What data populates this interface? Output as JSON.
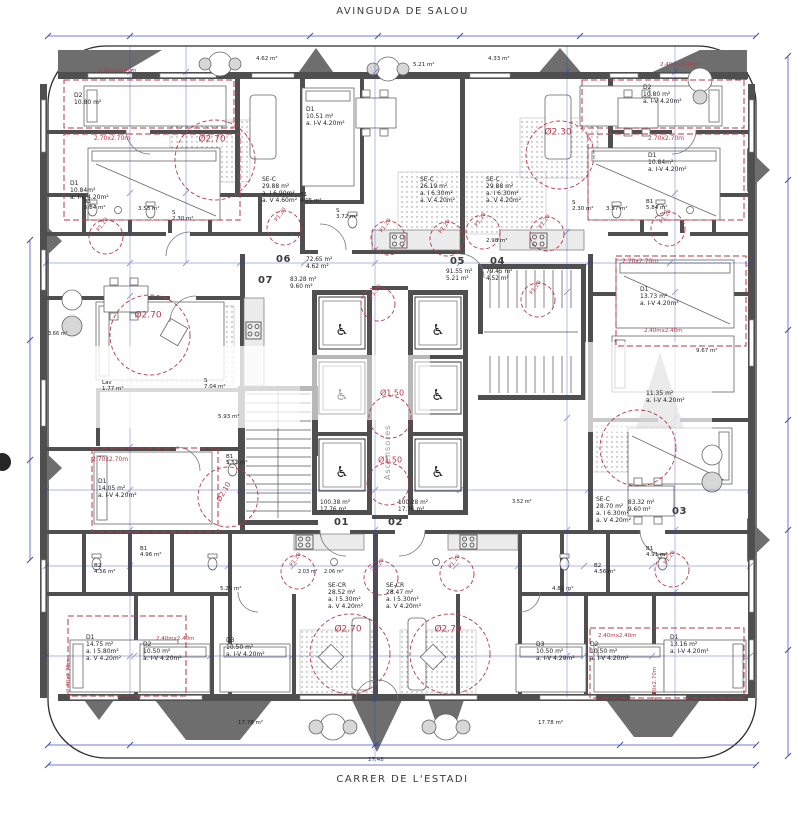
{
  "drawing": {
    "street_top": "AVINGUDA DE SALOU",
    "street_bottom": "CARRER DE L'ESTADI",
    "overall_dim": "27.48",
    "core": {
      "elevator_text": "Ascensores",
      "wheelchair_glyph": "♿",
      "cabins": 6
    },
    "colors": {
      "wall": "#4f4f4f",
      "red": "#b5394a",
      "blue": "#2e41b0",
      "divider": "#6e6e6e"
    },
    "units": [
      {
        "number": "07",
        "areas": [
          "83.28 m²",
          "9.60 m²"
        ],
        "nx": 258,
        "ny": 275,
        "ax": 290,
        "ay": 277
      },
      {
        "number": "06",
        "areas": [
          "72.65 m²",
          "4.62 m²"
        ],
        "nx": 276,
        "ny": 254,
        "ax": 306,
        "ay": 257
      },
      {
        "number": "05",
        "areas": [
          "91.55 m²",
          "5.21 m²"
        ],
        "nx": 450,
        "ny": 256,
        "ax": 446,
        "ay": 269
      },
      {
        "number": "04",
        "areas": [
          "79.45 m²",
          "4.52 m²"
        ],
        "nx": 490,
        "ny": 256,
        "ax": 486,
        "ay": 269
      },
      {
        "number": "01",
        "areas": [
          "100.38 m²",
          "17.76 m²"
        ],
        "nx": 334,
        "ny": 517,
        "ax": 320,
        "ay": 500
      },
      {
        "number": "02",
        "areas": [
          "100.28 m²",
          "17.76 m²"
        ],
        "nx": 388,
        "ny": 517,
        "ax": 398,
        "ay": 500
      },
      {
        "number": "03",
        "areas": [
          "83.32 m²",
          "9.60 m²"
        ],
        "nx": 672,
        "ny": 506,
        "ax": 628,
        "ay": 500
      }
    ],
    "room_labels": [
      {
        "name": "bedroom-d2-tl",
        "lines": [
          "D2",
          "10.80 m²"
        ],
        "x": 74,
        "y": 92
      },
      {
        "name": "bedroom-d1-tl",
        "lines": [
          "D1",
          "10.84m²",
          "a. I-V 4.20m²"
        ],
        "x": 70,
        "y": 180
      },
      {
        "name": "bath-b1-tl",
        "lines": [
          "B1",
          "5.84 m²"
        ],
        "x": 84,
        "y": 199,
        "size": 5.5
      },
      {
        "name": "bath-tl",
        "lines": [
          "3.53 m²"
        ],
        "x": 138,
        "y": 206,
        "size": 5.5
      },
      {
        "name": "storage-tl",
        "lines": [
          "S",
          "2.30 m²"
        ],
        "x": 172,
        "y": 210,
        "size": 5.5
      },
      {
        "name": "bedroom-d2-tr",
        "lines": [
          "D2",
          "10.80 m²",
          "a. I-V 4.20m²"
        ],
        "x": 643,
        "y": 84
      },
      {
        "name": "bedroom-d1-tr",
        "lines": [
          "D1",
          "10.84m²",
          "a. I-V 4.20m²"
        ],
        "x": 648,
        "y": 152
      },
      {
        "name": "bath-tr",
        "lines": [
          "3.57 m²"
        ],
        "x": 606,
        "y": 206,
        "size": 5.5
      },
      {
        "name": "bath-b1-tr",
        "lines": [
          "B1",
          "5.84 m²"
        ],
        "x": 646,
        "y": 199,
        "size": 5.5
      },
      {
        "name": "bedroom-d1-tc",
        "lines": [
          "D1",
          "10.51 m²",
          "a. I-V 4.20m²"
        ],
        "x": 306,
        "y": 106
      },
      {
        "name": "living-sec-06",
        "lines": [
          "SE-C",
          "29.88 m²",
          "a. I 6.90m²",
          "a. V 4.60m²"
        ],
        "x": 262,
        "y": 176
      },
      {
        "name": "living-sec-05",
        "lines": [
          "SE-C",
          "26.19 m²",
          "a. I 6.30m²",
          "a. V 4.20m²"
        ],
        "x": 420,
        "y": 176
      },
      {
        "name": "living-sec-04",
        "lines": [
          "SE-C",
          "29.88 m²",
          "a. I 6.30m²",
          "a. V 4.20m²"
        ],
        "x": 486,
        "y": 176
      },
      {
        "name": "bath-b1-06",
        "lines": [
          "B1",
          "4.05 m²"
        ],
        "x": 300,
        "y": 192,
        "size": 5.5
      },
      {
        "name": "storage-06",
        "lines": [
          "S",
          "3.72 m²"
        ],
        "x": 336,
        "y": 208,
        "size": 5.5
      },
      {
        "name": "hall-04",
        "lines": [
          "2.98 m²"
        ],
        "x": 486,
        "y": 238,
        "size": 5.5
      },
      {
        "name": "storage-04",
        "lines": [
          "S",
          "2.30 m²"
        ],
        "x": 572,
        "y": 200,
        "size": 5.5
      },
      {
        "name": "laundry-07",
        "lines": [
          "Lav",
          "1.77 m²"
        ],
        "x": 102,
        "y": 380,
        "size": 5.5
      },
      {
        "name": "storage-07",
        "lines": [
          "S",
          "7.04 m²"
        ],
        "x": 204,
        "y": 378,
        "size": 5.5
      },
      {
        "name": "hall-07",
        "lines": [
          "5.93 m²"
        ],
        "x": 218,
        "y": 414,
        "size": 5.5
      },
      {
        "name": "bath-b1-07",
        "lines": [
          "B1",
          "5.52 m²"
        ],
        "x": 226,
        "y": 454,
        "size": 5.5
      },
      {
        "name": "bedroom-d1-07",
        "lines": [
          "D1",
          "14.05 m²",
          "a. I-V 4.20m²"
        ],
        "x": 98,
        "y": 478
      },
      {
        "name": "balcony-left",
        "lines": [
          "3.66 m²"
        ],
        "x": 48,
        "y": 332,
        "size": 5
      },
      {
        "name": "bedroom-d1-03",
        "lines": [
          "D1",
          "13.73 m²",
          "a. I-V 4.20m²"
        ],
        "x": 640,
        "y": 286
      },
      {
        "name": "balcony-right",
        "lines": [
          "9.67 m²"
        ],
        "x": 696,
        "y": 348,
        "size": 5.5
      },
      {
        "name": "bedroom-d2-03",
        "lines": [
          "11.35 m²",
          "a. I-V 4.20m²"
        ],
        "x": 646,
        "y": 390
      },
      {
        "name": "living-sec-03",
        "lines": [
          "SE-C",
          "28.70 m²",
          "a. I 6.30m²",
          "a. V 4.20m²"
        ],
        "x": 596,
        "y": 496
      },
      {
        "name": "bath-b1-03",
        "lines": [
          "B1",
          "4.91 m²"
        ],
        "x": 646,
        "y": 546,
        "size": 5.5
      },
      {
        "name": "bath-b2-03",
        "lines": [
          "B2",
          "4.56 m²"
        ],
        "x": 594,
        "y": 563,
        "size": 5.5
      },
      {
        "name": "bath-b1-left",
        "lines": [
          "B1",
          "4.96 m²"
        ],
        "x": 140,
        "y": 546,
        "size": 5.5
      },
      {
        "name": "bath-b2-left",
        "lines": [
          "B2",
          "4.56 m²"
        ],
        "x": 94,
        "y": 563,
        "size": 5.5
      },
      {
        "name": "storage-01",
        "lines": [
          "2.03 m²"
        ],
        "x": 298,
        "y": 570,
        "size": 5
      },
      {
        "name": "storage-02",
        "lines": [
          "2.06 m²"
        ],
        "x": 324,
        "y": 570,
        "size": 5
      },
      {
        "name": "hall-left",
        "lines": [
          "5.25 m²"
        ],
        "x": 220,
        "y": 586,
        "size": 5.5
      },
      {
        "name": "hall-right",
        "lines": [
          "4.81 m²"
        ],
        "x": 552,
        "y": 586,
        "size": 5.5
      },
      {
        "name": "living-secr-01",
        "lines": [
          "SE-CR",
          "28.52 m²",
          "a. I 5.30m²",
          "a. V 4.20m²"
        ],
        "x": 328,
        "y": 582
      },
      {
        "name": "living-secr-02",
        "lines": [
          "SE-CR",
          "28.47 m²",
          "a. I 5.30m²",
          "a. V 4.20m²"
        ],
        "x": 386,
        "y": 582
      },
      {
        "name": "bedroom-d1-bl",
        "lines": [
          "D1",
          "14.75 m²",
          "a. I 5.80m²",
          "a. V 4.20m²"
        ],
        "x": 86,
        "y": 634
      },
      {
        "name": "bedroom-d2-bl",
        "lines": [
          "D2",
          "10.50 m²",
          "a. I-V 4.20m²"
        ],
        "x": 143,
        "y": 641
      },
      {
        "name": "bedroom-d3-bl",
        "lines": [
          "D3",
          "10.50 m²",
          "a. I-V 4.20m²"
        ],
        "x": 226,
        "y": 637
      },
      {
        "name": "bedroom-d3-br",
        "lines": [
          "D3",
          "10.50 m²",
          "a. I-V 4.20m²"
        ],
        "x": 536,
        "y": 641
      },
      {
        "name": "bedroom-d2-br",
        "lines": [
          "D2",
          "10.50 m²",
          "a. I-V 4.20m²"
        ],
        "x": 590,
        "y": 641
      },
      {
        "name": "bedroom-d1-br",
        "lines": [
          "D1",
          "13.16 m²",
          "a. I-V 4.20m²"
        ],
        "x": 670,
        "y": 634
      },
      {
        "name": "balcony-bl",
        "lines": [
          "17.78 m²"
        ],
        "x": 238,
        "y": 720,
        "size": 5.5
      },
      {
        "name": "balcony-br",
        "lines": [
          "17.78 m²"
        ],
        "x": 538,
        "y": 720,
        "size": 5.5
      },
      {
        "name": "balcony-t1",
        "lines": [
          "4.62 m²"
        ],
        "x": 256,
        "y": 56,
        "size": 5.5
      },
      {
        "name": "balcony-t2",
        "lines": [
          "5.21 m²"
        ],
        "x": 413,
        "y": 62,
        "size": 5.5
      },
      {
        "name": "balcony-t3",
        "lines": [
          "4.33 m²"
        ],
        "x": 488,
        "y": 56,
        "size": 5.5
      },
      {
        "name": "hall-03",
        "lines": [
          "3.52 m²"
        ],
        "x": 512,
        "y": 500,
        "size": 5
      }
    ],
    "red_labels": [
      {
        "name": "bed-clearance",
        "text": "2.40mx2.40m",
        "x": 98,
        "y": 68,
        "size": 5.5
      },
      {
        "name": "bed-clearance",
        "text": "2.70x2.70m",
        "x": 94,
        "y": 135,
        "size": 6
      },
      {
        "name": "bed-clearance",
        "text": "2.40mx2.40m",
        "x": 660,
        "y": 62,
        "size": 5.5
      },
      {
        "name": "bed-clearance",
        "text": "2.70x2.70m",
        "x": 648,
        "y": 135,
        "size": 6
      },
      {
        "name": "turning-diameter",
        "text": "Ø2.70",
        "x": 212,
        "y": 140,
        "size": 9,
        "anchor": "c"
      },
      {
        "name": "turning-diameter",
        "text": "Ø2.30",
        "x": 558,
        "y": 133,
        "size": 9,
        "anchor": "c"
      },
      {
        "name": "turning-diameter",
        "text": "Ø2.70",
        "x": 148,
        "y": 316,
        "size": 9,
        "anchor": "c"
      },
      {
        "name": "turning-diameter",
        "text": "Ø1.50",
        "x": 392,
        "y": 393,
        "size": 8,
        "anchor": "c"
      },
      {
        "name": "turning-diameter",
        "text": "Ø1.50",
        "x": 390,
        "y": 460,
        "size": 8,
        "anchor": "c"
      },
      {
        "name": "turning-diameter",
        "text": "Ø2.70",
        "x": 348,
        "y": 630,
        "size": 9,
        "anchor": "c"
      },
      {
        "name": "turning-diameter",
        "text": "Ø2.70",
        "x": 448,
        "y": 630,
        "size": 9,
        "anchor": "c"
      },
      {
        "name": "bed-clearance",
        "text": "2.70x2.70m",
        "x": 622,
        "y": 258,
        "size": 6
      },
      {
        "name": "bed-clearance",
        "text": "2.40mx2.40m",
        "x": 644,
        "y": 328,
        "size": 5.5
      },
      {
        "name": "bed-clearance",
        "text": "2.70x2.70m",
        "x": 92,
        "y": 456,
        "size": 6
      },
      {
        "name": "bed-clearance",
        "text": "2.40mx2.40m",
        "x": 156,
        "y": 636,
        "size": 5.5
      },
      {
        "name": "bed-clearance",
        "text": "2.40mx2.40m",
        "x": 598,
        "y": 633,
        "size": 5.5
      },
      {
        "name": "bed-clearance",
        "text": "2.70x2.70m",
        "x": 66,
        "y": 692,
        "size": 5.5,
        "rot": -90
      },
      {
        "name": "bed-clearance",
        "text": "2.70x2.70m",
        "x": 652,
        "y": 700,
        "size": 5.5,
        "rot": -90
      },
      {
        "name": "turning-diameter",
        "text": "Ø2.10",
        "x": 224,
        "y": 492,
        "size": 7,
        "rot": -60,
        "anchor": "c"
      },
      {
        "name": "door-clearance",
        "text": "P1.20",
        "x": 103,
        "y": 225,
        "size": 5.5,
        "rot": -55,
        "anchor": "c"
      },
      {
        "name": "door-clearance",
        "text": "P1.20",
        "x": 281,
        "y": 215,
        "size": 5.5,
        "rot": -55,
        "anchor": "c"
      },
      {
        "name": "door-clearance",
        "text": "P1.20",
        "x": 386,
        "y": 226,
        "size": 5.5,
        "rot": -55,
        "anchor": "c"
      },
      {
        "name": "door-clearance",
        "text": "P1.20",
        "x": 445,
        "y": 227,
        "size": 5.5,
        "rot": -55,
        "anchor": "c"
      },
      {
        "name": "door-clearance",
        "text": "P1.20",
        "x": 481,
        "y": 220,
        "size": 5.5,
        "rot": -55,
        "anchor": "c"
      },
      {
        "name": "door-clearance",
        "text": "P1.20",
        "x": 545,
        "y": 222,
        "size": 5.5,
        "rot": -55,
        "anchor": "c"
      },
      {
        "name": "door-clearance",
        "text": "P1.20",
        "x": 536,
        "y": 288,
        "size": 5.5,
        "rot": -55,
        "anchor": "c"
      },
      {
        "name": "door-clearance",
        "text": "P1.20",
        "x": 666,
        "y": 217,
        "size": 5.5,
        "rot": -55,
        "anchor": "c"
      },
      {
        "name": "door-clearance",
        "text": "P1.20",
        "x": 296,
        "y": 560,
        "size": 5.5,
        "rot": -55,
        "anchor": "c"
      },
      {
        "name": "door-clearance",
        "text": "P1.20",
        "x": 379,
        "y": 566,
        "size": 5.5,
        "rot": -55,
        "anchor": "c"
      },
      {
        "name": "door-clearance",
        "text": "P1.20",
        "x": 455,
        "y": 562,
        "size": 5.5,
        "rot": -55,
        "anchor": "c"
      },
      {
        "name": "door-clearance",
        "text": "P1.20",
        "x": 670,
        "y": 558,
        "size": 5.5,
        "rot": -55,
        "anchor": "c"
      },
      {
        "name": "door-clearance",
        "text": "P1.20",
        "x": 376,
        "y": 292,
        "size": 5.5,
        "rot": -55,
        "anchor": "c"
      }
    ],
    "red_circles": [
      {
        "x": 150,
        "y": 335,
        "r": 40
      },
      {
        "x": 215,
        "y": 160,
        "r": 40
      },
      {
        "x": 560,
        "y": 155,
        "r": 34
      },
      {
        "x": 350,
        "y": 654,
        "r": 40
      },
      {
        "x": 450,
        "y": 654,
        "r": 40
      },
      {
        "x": 390,
        "y": 417,
        "r": 21
      },
      {
        "x": 388,
        "y": 484,
        "r": 21
      },
      {
        "x": 638,
        "y": 448,
        "r": 38
      },
      {
        "x": 228,
        "y": 497,
        "r": 30
      },
      {
        "x": 106,
        "y": 237,
        "r": 17
      },
      {
        "x": 284,
        "y": 228,
        "r": 17
      },
      {
        "x": 388,
        "y": 238,
        "r": 17
      },
      {
        "x": 447,
        "y": 239,
        "r": 17
      },
      {
        "x": 483,
        "y": 232,
        "r": 17
      },
      {
        "x": 547,
        "y": 234,
        "r": 17
      },
      {
        "x": 538,
        "y": 300,
        "r": 17
      },
      {
        "x": 668,
        "y": 229,
        "r": 17
      },
      {
        "x": 298,
        "y": 572,
        "r": 17
      },
      {
        "x": 381,
        "y": 578,
        "r": 17
      },
      {
        "x": 457,
        "y": 574,
        "r": 17
      },
      {
        "x": 672,
        "y": 570,
        "r": 17
      },
      {
        "x": 378,
        "y": 304,
        "r": 17
      }
    ],
    "red_rects": [
      {
        "x": 64,
        "y": 80,
        "w": 170,
        "h": 48
      },
      {
        "x": 64,
        "y": 134,
        "w": 176,
        "h": 86
      },
      {
        "x": 582,
        "y": 80,
        "w": 162,
        "h": 48
      },
      {
        "x": 588,
        "y": 134,
        "w": 156,
        "h": 86
      },
      {
        "x": 92,
        "y": 448,
        "w": 126,
        "h": 84
      },
      {
        "x": 616,
        "y": 256,
        "w": 130,
        "h": 90
      },
      {
        "x": 68,
        "y": 616,
        "w": 118,
        "h": 80
      },
      {
        "x": 590,
        "y": 628,
        "w": 154,
        "h": 70
      }
    ]
  }
}
